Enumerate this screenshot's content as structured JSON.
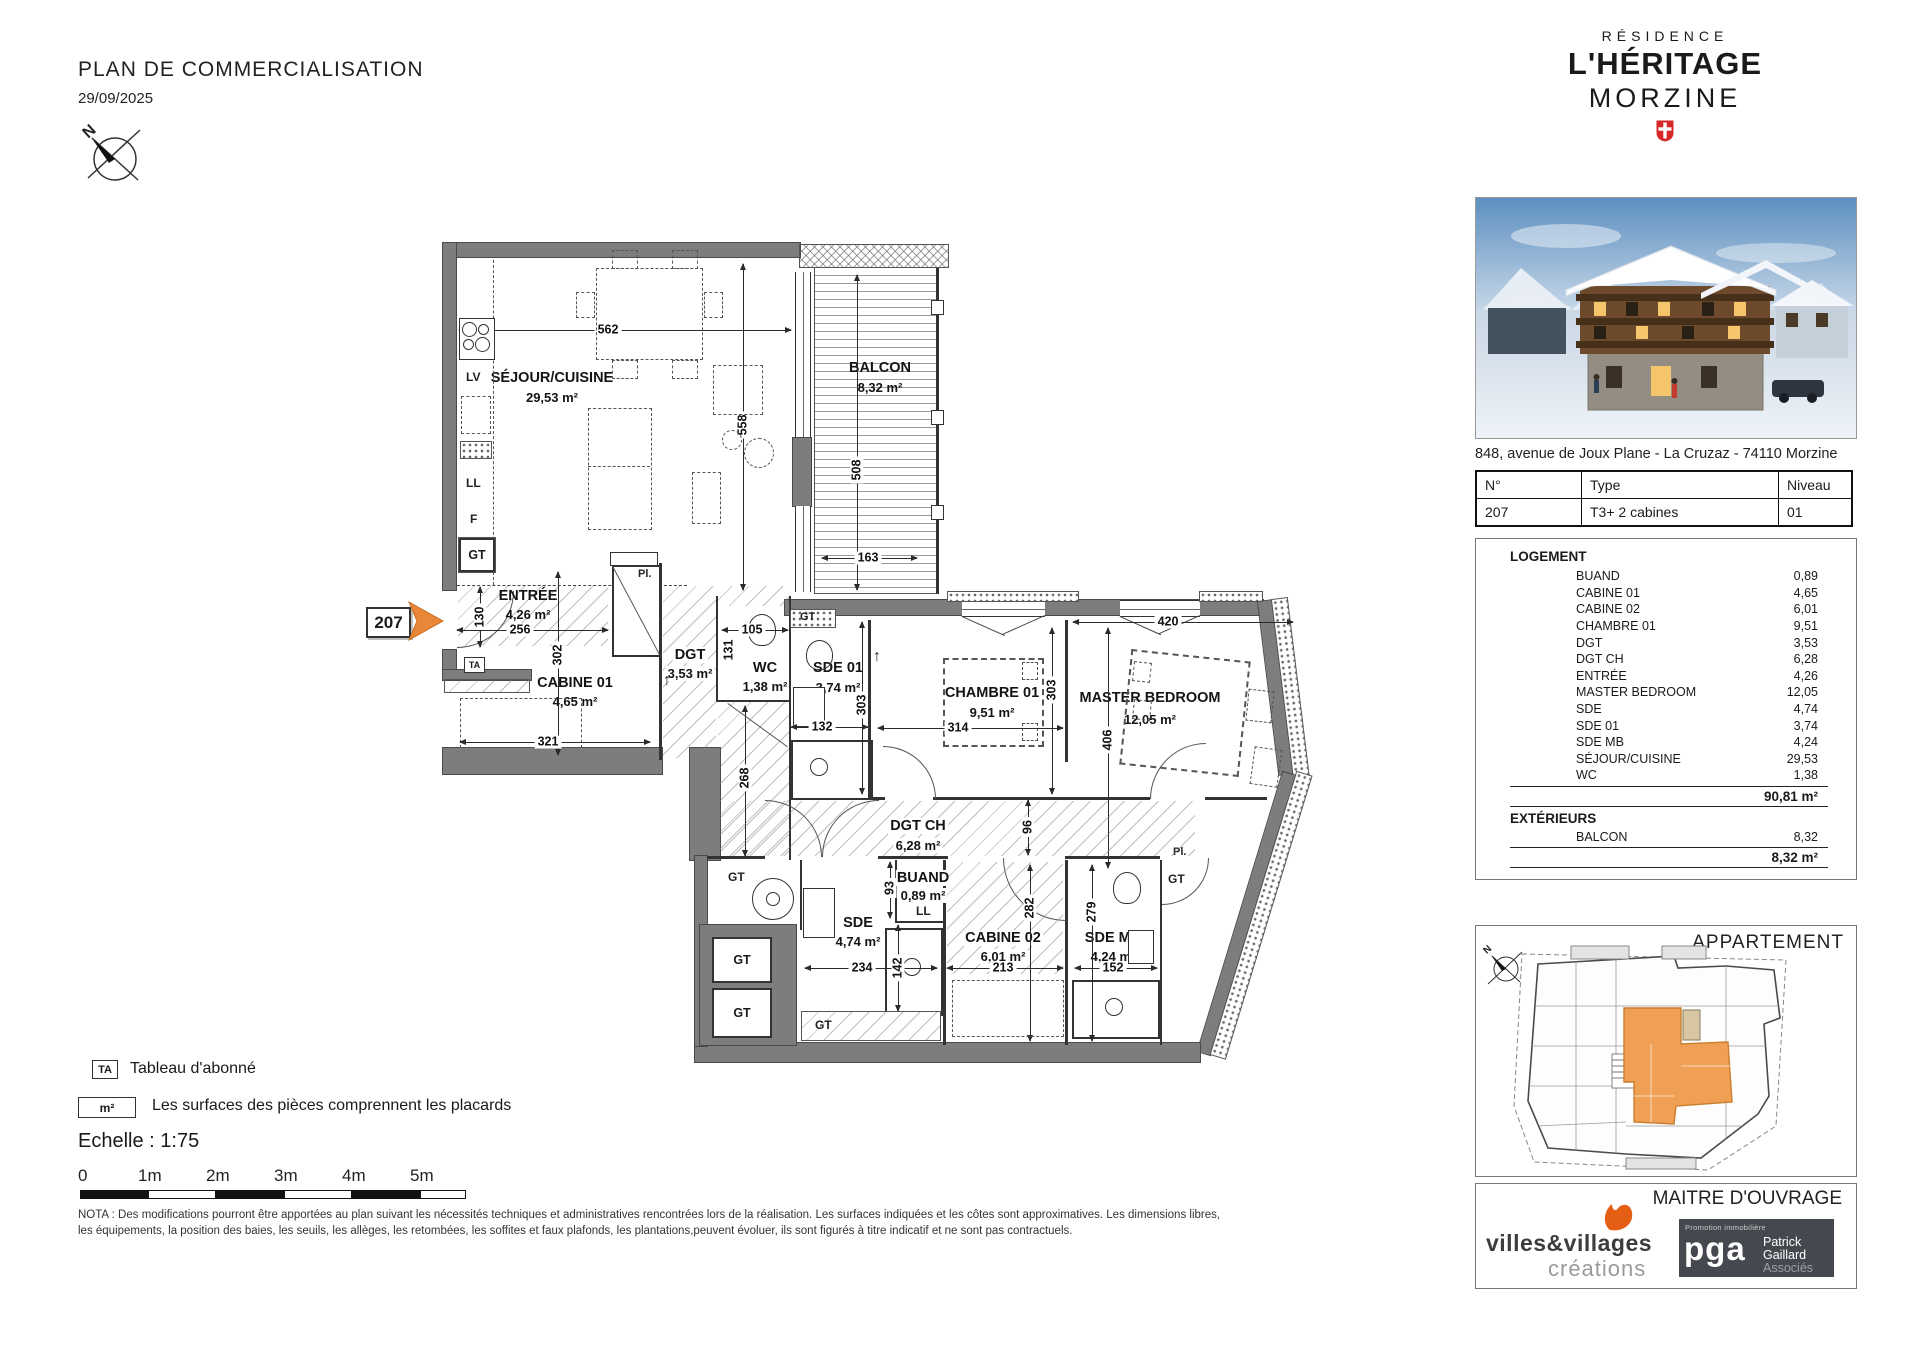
{
  "header": {
    "title": "PLAN DE COMMERCIALISATION",
    "date": "29/09/2025"
  },
  "brand": {
    "line1": "RÉSIDENCE",
    "line2": "L'HÉRITAGE",
    "line3": "MORZINE"
  },
  "address": "848, avenue de Joux Plane - La Cruzaz - 74110 Morzine",
  "unit_table": {
    "headers": [
      "N°",
      "Type",
      "Niveau"
    ],
    "row": [
      "207",
      "T3+ 2 cabines",
      "01"
    ]
  },
  "surfaces": {
    "logement_title": "LOGEMENT",
    "rows": [
      {
        "label": "BUAND",
        "value": "0,89"
      },
      {
        "label": "CABINE 01",
        "value": "4,65"
      },
      {
        "label": "CABINE 02",
        "value": "6,01"
      },
      {
        "label": "CHAMBRE 01",
        "value": "9,51"
      },
      {
        "label": "DGT",
        "value": "3,53"
      },
      {
        "label": "DGT CH",
        "value": "6,28"
      },
      {
        "label": "ENTRÉE",
        "value": "4,26"
      },
      {
        "label": "MASTER BEDROOM",
        "value": "12,05"
      },
      {
        "label": "SDE",
        "value": "4,74"
      },
      {
        "label": "SDE 01",
        "value": "3,74"
      },
      {
        "label": "SDE MB",
        "value": "4,24"
      },
      {
        "label": "SÉJOUR/CUISINE",
        "value": "29,53"
      },
      {
        "label": "WC",
        "value": "1,38"
      }
    ],
    "total": "90,81 m²",
    "ext_title": "EXTÉRIEURS",
    "ext_rows": [
      {
        "label": "BALCON",
        "value": "8,32"
      }
    ],
    "ext_total": "8,32 m²"
  },
  "apartment_box": {
    "title": "APPARTEMENT"
  },
  "moa": {
    "title": "MAITRE D'OUVRAGE",
    "vv_line1": "villes&villages",
    "vv_line2": "créations",
    "pga_small": "Promotion immobilière",
    "pga_big": "pga",
    "pga_r1": "Patrick",
    "pga_r2": "Gaillard",
    "pga_r3": "Associés"
  },
  "legend": {
    "ta_symbol": "TA",
    "ta_label": "Tableau d'abonné",
    "m2_symbol": "m²",
    "m2_label": "Les surfaces des pièces comprennent les placards",
    "echelle": "Echelle : 1:75",
    "scale_labels": [
      "0",
      "1m",
      "2m",
      "3m",
      "4m",
      "5m"
    ],
    "nota": "NOTA : Des modifications pourront être apportées au plan suivant les nécessités techniques et administratives rencontrées lors de la réalisation. Les surfaces indiquées et les côtes sont approximatives. Les dimensions libres, les équipements, la position des baies, les seuils, les allèges, les retombées, les soffites et faux plafonds, les plantations,peuvent évoluer, ils sont figurés à titre indicatif et ne sont pas contractuels."
  },
  "floorplan": {
    "unit_number": "207",
    "rooms": {
      "sejour": {
        "name": "SÉJOUR/CUISINE",
        "area": "29,53 m²"
      },
      "balcon": {
        "name": "BALCON",
        "area": "8,32 m²"
      },
      "entree": {
        "name": "ENTRÉE",
        "area": "4,26 m²"
      },
      "cabine01": {
        "name": "CABINE 01",
        "area": "4,65 m²"
      },
      "dgt": {
        "name": "DGT",
        "area": "3,53 m²"
      },
      "wc": {
        "name": "WC",
        "area": "1,38 m²"
      },
      "sde01": {
        "name": "SDE 01",
        "area": "3,74 m²"
      },
      "chambre01": {
        "name": "CHAMBRE 01",
        "area": "9,51 m²"
      },
      "master": {
        "name": "MASTER BEDROOM",
        "area": "12,05 m²"
      },
      "dgtch": {
        "name": "DGT CH",
        "area": "6,28 m²"
      },
      "buand": {
        "name": "BUAND",
        "area": "0,89 m²"
      },
      "sde": {
        "name": "SDE",
        "area": "4,74 m²"
      },
      "cabine02": {
        "name": "CABINE 02",
        "area": "6,01 m²"
      },
      "sdemb": {
        "name": "SDE MB",
        "area": "4,24 m²"
      }
    },
    "dims": {
      "sejour_w": "562",
      "sejour_h": "558",
      "balcon_h": "508",
      "balcon_w": "163",
      "entree_h": "130",
      "entree_w": "256",
      "cabine01_h": "302",
      "cabine01_w": "321",
      "wc_w": "105",
      "wc_h": "131",
      "sde01_h": "303",
      "sde01_w": "132",
      "chambre01_w": "314",
      "chambre01_h": "303",
      "master_w": "420",
      "master_h": "406",
      "dgt_h": "268",
      "dgtch_h": "96",
      "buand_h": "93",
      "sde_w": "234",
      "sde_h": "142",
      "cabine02_w": "213",
      "cabine02_h": "282",
      "sdemb_w": "152",
      "sdemb_h": "279"
    },
    "tags": {
      "lv": "LV",
      "ll": "LL",
      "f": "F",
      "gt": "GT",
      "ta": "TA",
      "pl": "Pl.",
      "arrow": "↑"
    }
  },
  "colors": {
    "accent_orange": "#e8873a",
    "minimap_orange": "#efa054",
    "savoie_red": "#d62828",
    "wall_gray": "#7d7d7d",
    "vv_orange": "#e45f15"
  }
}
